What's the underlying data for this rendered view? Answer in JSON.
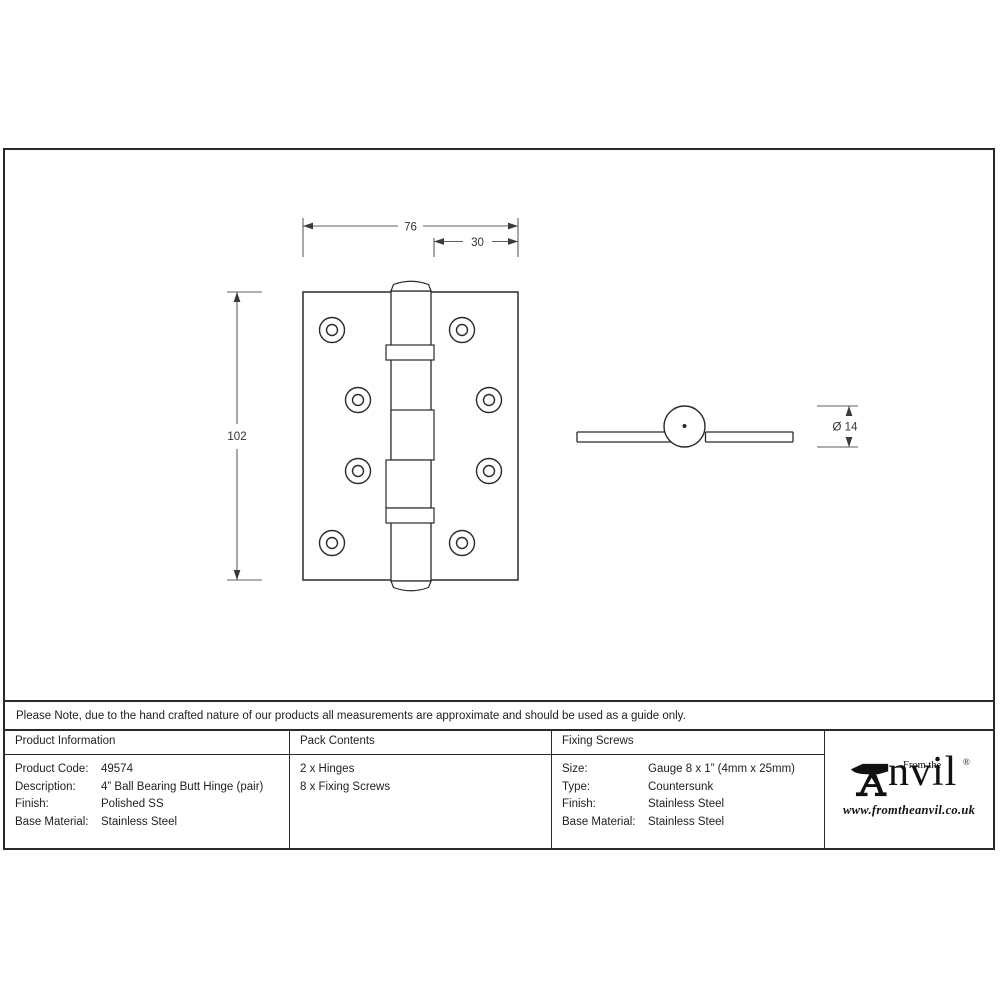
{
  "page": {
    "note": "Please Note, due to the hand crafted nature of our products all measurements are approximate and should be used as a guide only."
  },
  "drawing": {
    "front_view": {
      "width_dim": "76",
      "offset_dim": "30",
      "height_dim": "102"
    },
    "side_view": {
      "diameter_dim": "Ø 14"
    }
  },
  "table": {
    "product_information": {
      "header": "Product Information",
      "rows": [
        {
          "label": "Product Code:",
          "value": "49574"
        },
        {
          "label": "Description:",
          "value": "4” Ball Bearing Butt Hinge (pair)"
        },
        {
          "label": "Finish:",
          "value": "Polished SS"
        },
        {
          "label": "Base Material:",
          "value": "Stainless Steel"
        }
      ]
    },
    "pack_contents": {
      "header": "Pack Contents",
      "items": [
        "2 x Hinges",
        "8 x Fixing Screws"
      ]
    },
    "fixing_screws": {
      "header": "Fixing Screws",
      "rows": [
        {
          "label": "Size:",
          "value": "Gauge 8 x 1” (4mm x 25mm)"
        },
        {
          "label": "Type:",
          "value": "Countersunk"
        },
        {
          "label": "Finish:",
          "value": "Stainless Steel"
        },
        {
          "label": "Base Material:",
          "value": "Stainless Steel"
        }
      ]
    }
  },
  "logo": {
    "tagline": "From the",
    "brand_text": "nvil",
    "registered": "®",
    "website": "www.fromtheanvil.co.uk"
  }
}
